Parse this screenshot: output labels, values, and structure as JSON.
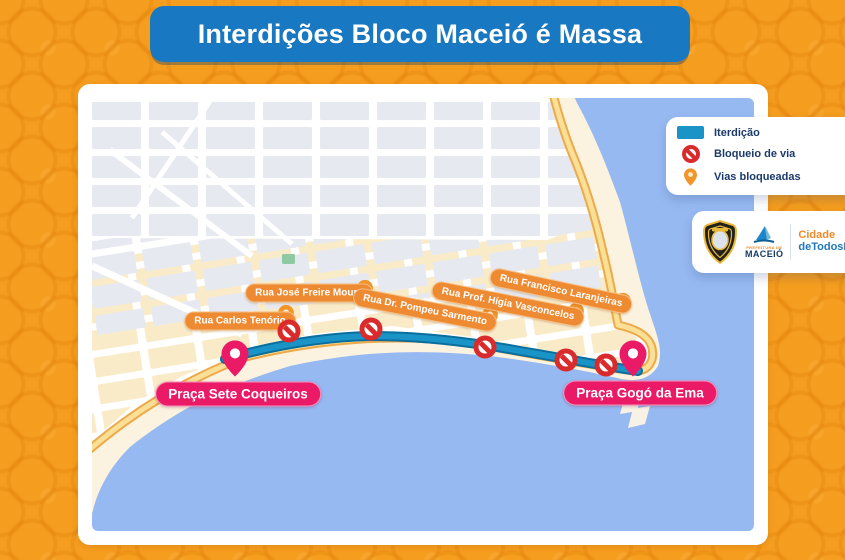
{
  "title": "Interdições Bloco Maceió é Massa",
  "legend": {
    "items": [
      {
        "icon": "interdiction-line-swatch",
        "label": "Iterdição"
      },
      {
        "icon": "road-block-icon",
        "label": "Bloqueio de via"
      },
      {
        "icon": "blocked-way-pin-icon",
        "label": "Vias bloqueadas"
      }
    ]
  },
  "branding": {
    "prefeitura_small": "PREFEITURA DE",
    "prefeitura_name": "MACEIÓ",
    "slogan_line1": "Cidade",
    "slogan_line2": "deTodosNós"
  },
  "map": {
    "interdiction_path_d": "M133,261 C180,248 230,239 278,238 C330,238 380,244 428,253 C470,260 512,268 546,273",
    "streets": [
      {
        "label": "Rua Carlos Tenório",
        "x": 148,
        "y": 223,
        "rot": 0,
        "pin": {
          "x": 194,
          "y": 227
        }
      },
      {
        "label": "Rua José Freire Moura",
        "x": 217,
        "y": 195,
        "rot": 0,
        "pin": {
          "x": 273,
          "y": 202
        }
      },
      {
        "label": "Rua Dr. Pompeu Sarmento",
        "x": 333,
        "y": 212,
        "rot": 11,
        "pin": {
          "x": 398,
          "y": 229
        }
      },
      {
        "label": "Rua Prof. Hígia Vasconcelos",
        "x": 416,
        "y": 206,
        "rot": 11,
        "pin": {
          "x": 484,
          "y": 225
        }
      },
      {
        "label": "Rua Francisco Laranjeiras",
        "x": 469,
        "y": 193,
        "rot": 12,
        "pin": {
          "x": 531,
          "y": 215
        }
      }
    ],
    "places": [
      {
        "label": "Praça Sete Coqueiros",
        "label_x": 146,
        "label_y": 296,
        "pin": {
          "x": 143,
          "y": 277
        }
      },
      {
        "label": "Praça Gogó da Ema",
        "label_x": 548,
        "label_y": 295,
        "pin": {
          "x": 541,
          "y": 277
        }
      }
    ],
    "roadblocks": [
      {
        "x": 197,
        "y": 233
      },
      {
        "x": 279,
        "y": 231
      },
      {
        "x": 393,
        "y": 249
      },
      {
        "x": 474,
        "y": 262
      },
      {
        "x": 514,
        "y": 267
      }
    ]
  },
  "colors": {
    "background_orange": "#F59D1E",
    "banner_blue": "#1878C1",
    "water_blue": "#97B9F2",
    "sand": "#FBF3DF",
    "road_yellow": "#F9E096",
    "road_casing": "#EDA94A",
    "interdiction_blue": "#1A93C7",
    "roadblock_red": "#D92B2B",
    "street_label_orange": "#EE8A31",
    "pin_orange": "#F2952B",
    "place_pink": "#EA1A67",
    "legend_text_navy": "#1B3A6B"
  }
}
